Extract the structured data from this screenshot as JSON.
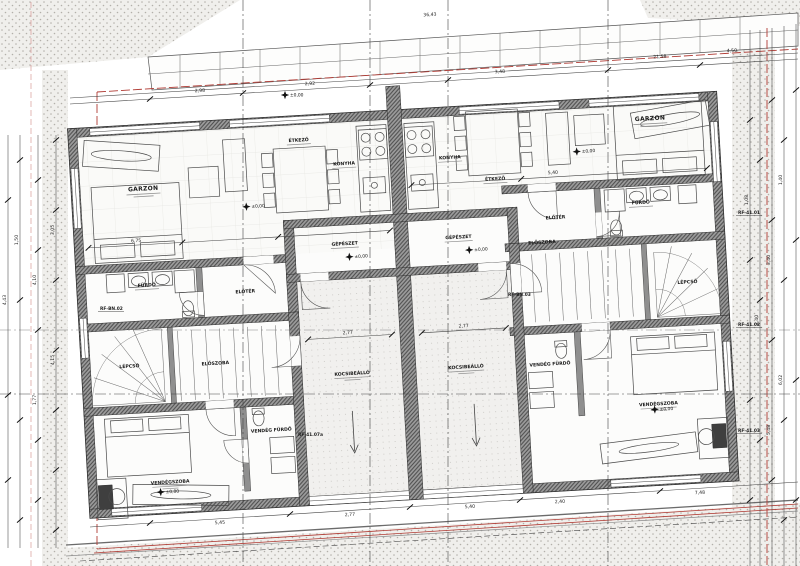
{
  "rooms": {
    "garzon": "GARZON",
    "konyha": "KONYHA",
    "etkezo": "ÉTKEZŐ",
    "furdo": "FÜRDŐ",
    "eloter": "ELŐTÉR",
    "eloszoba": "ELŐSZOBA",
    "lepcso": "LÉPCSŐ",
    "gepeszet": "GÉPÉSZET",
    "kocsibeallo": "KOCSIBEÁLLÓ",
    "vendegszoba": "VENDÉGSZOBA",
    "vendeg_furdo": "VENDÉG FÜRDŐ"
  },
  "levels": {
    "zero": "±0,00"
  },
  "tags": {
    "rf1": "RF-41.01",
    "rf2": "RF-41.02",
    "rf3": "RF-41.03",
    "rf4": "RF-BN.02",
    "rf5": "RF-BN.03",
    "rf6": "RF-41.07a"
  },
  "dims": {
    "top": [
      "36,43",
      "2,98",
      "2,92",
      "3,48",
      "21,58",
      "4,50"
    ],
    "left": [
      "4,43",
      "1,50",
      "4,10",
      "1,77",
      "3,05",
      "4,15"
    ],
    "right": [
      "1,08",
      "2,40",
      "3,40",
      "5,48",
      "1,40",
      "6,02"
    ],
    "bottom": [
      "5,45",
      "2,77",
      "5,40",
      "2,40",
      "7,48"
    ],
    "inner": {
      "garzon_left": "6,75",
      "garzon_right": "5,40",
      "carport_left": "2,77",
      "carport_right": "2,77"
    }
  },
  "colors": {
    "boundary_red": "#b03a33",
    "wall_gray": "#9c9c9c",
    "line_dark": "#3c3c3c",
    "dot_beige": "#b3b0aa"
  }
}
